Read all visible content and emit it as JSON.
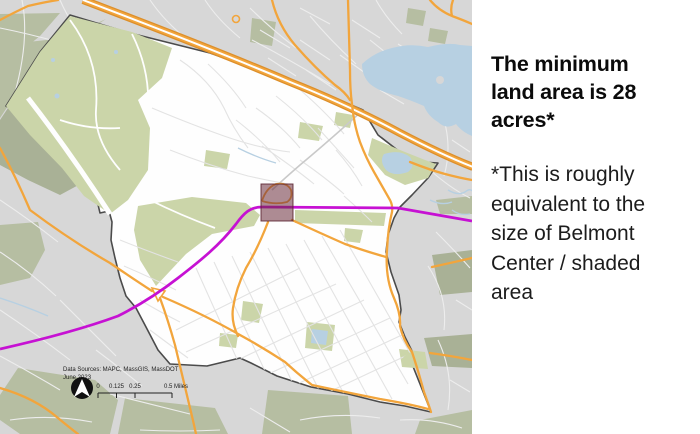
{
  "panel": {
    "heading_text": "The minimum land area is 28 acres*",
    "heading_lines": [
      "The minimum",
      "land area is 28",
      "acres*"
    ],
    "body_text": "*This is roughly equivalent to the size of Belmont Center / shaded area",
    "body_lines": [
      "*This is roughly",
      "equivalent to the",
      "size of Belmont",
      "Center / shaded",
      "area"
    ]
  },
  "map": {
    "credits": {
      "line1": "Data Sources: MAPC, MassGIS, MassDOT",
      "line2": "June 2023"
    },
    "scale": {
      "labels": [
        "0",
        "0.125",
        "0.25",
        "0.5 Miles"
      ]
    },
    "features": {
      "shaded_area": "Belmont Center shaded square",
      "boundary": "town boundary",
      "transit": "rail transit line",
      "highway": "Route 2 divided highway"
    }
  },
  "colors": {
    "panel-background": "#ffffff",
    "heading-color": "#0b0b0b",
    "body-color": "#1c1c1c",
    "map-background": "#d7d7d7",
    "outside-street": "#ededed",
    "inside-street": "#e3e3e3",
    "town-fill": "#fefefe",
    "boundary-color": "#4b4b4b",
    "open-space": "#cbd5a9",
    "open-space-muted": "#b6bea2",
    "open-space-dark": "#a9b196",
    "water-color": "#b7d0e2",
    "road-orange": "#f2a53c",
    "road-orange-casing": "#dc8f2b",
    "rail-magenta": "#c611d3",
    "shaded-fill": "rgba(106,44,58,0.55)",
    "shaded-stroke": "rgba(88,33,46,0.85)",
    "annotation-color": "#222222"
  }
}
